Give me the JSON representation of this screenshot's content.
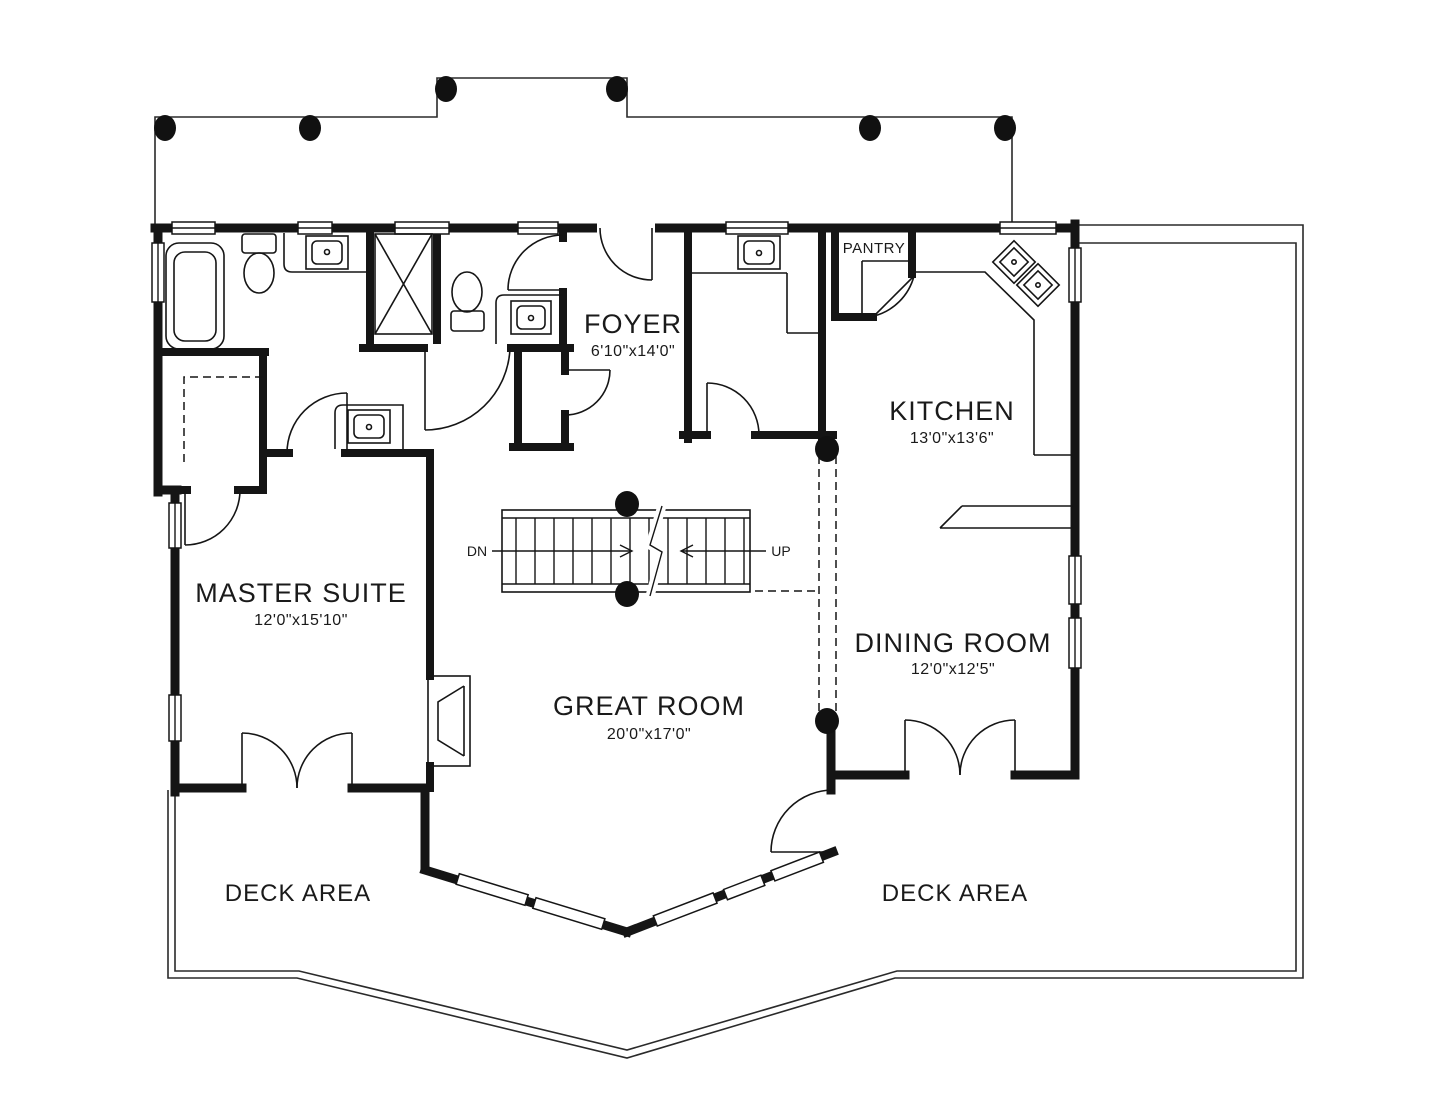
{
  "document": {
    "type": "floor-plan"
  },
  "rooms": {
    "foyer": {
      "label": "FOYER",
      "dims": "6'10\"x14'0\""
    },
    "kitchen": {
      "label": "KITCHEN",
      "dims": "13'0\"x13'6\""
    },
    "pantry": {
      "label": "PANTRY"
    },
    "master_suite": {
      "label": "MASTER SUITE",
      "dims": "12'0\"x15'10\""
    },
    "great_room": {
      "label": "GREAT ROOM",
      "dims": "20'0\"x17'0\""
    },
    "dining_room": {
      "label": "DINING ROOM",
      "dims": "12'0\"x12'5\""
    },
    "deck_left": {
      "label": "DECK AREA"
    },
    "deck_right": {
      "label": "DECK AREA"
    }
  },
  "stairs": {
    "down": "DN",
    "up": "UP"
  },
  "colors": {
    "ink": "#151515",
    "background": "#ffffff"
  }
}
